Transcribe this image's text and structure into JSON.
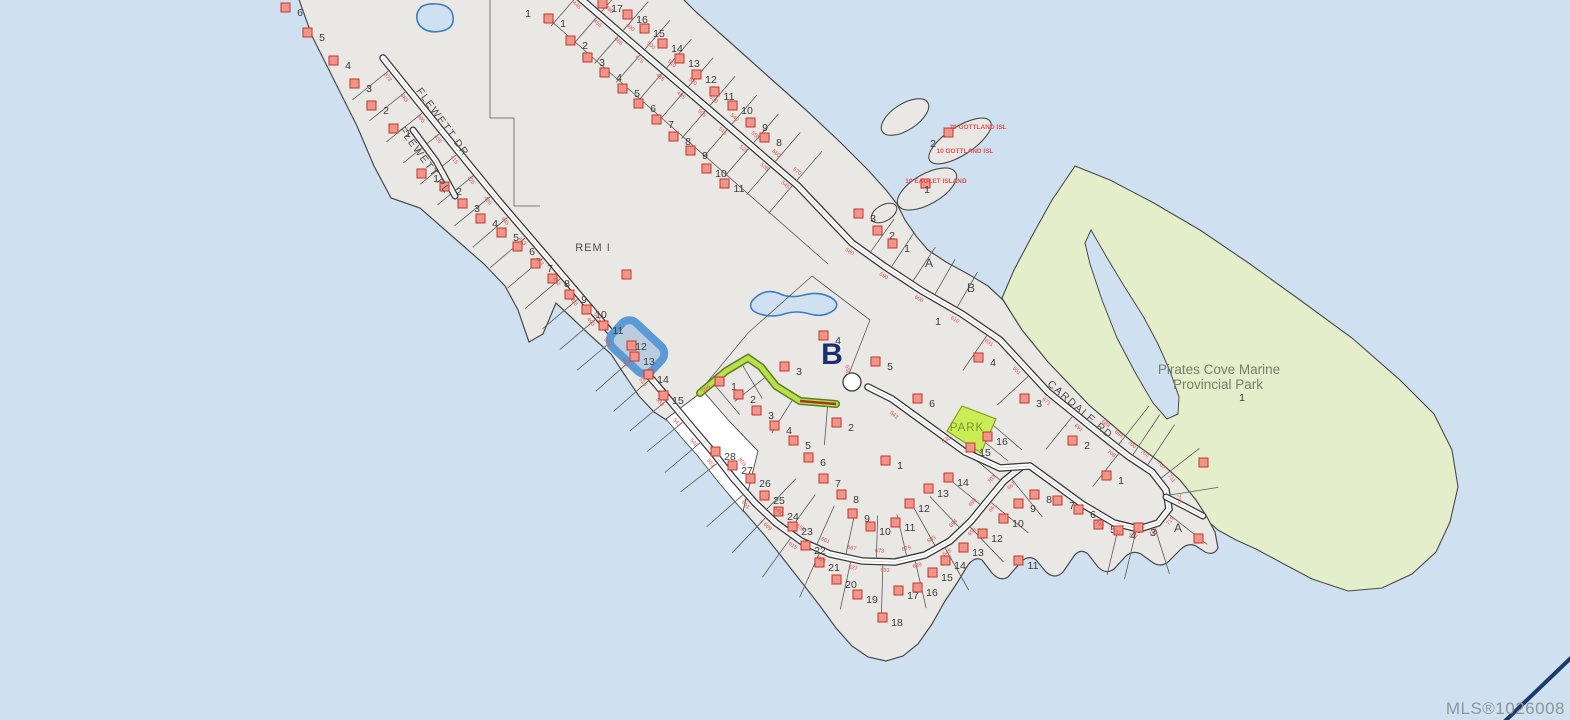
{
  "map": {
    "watermark": "MLS®1026008",
    "selected_lot": "12",
    "roads": [
      {
        "name": "FLEWETT DR"
      },
      {
        "name": "FLEWETT PL"
      },
      {
        "name": "CARDALE RD"
      }
    ],
    "areas": {
      "rem": "REM I",
      "park_name_line1": "Pirates Cove Marine",
      "park_name_line2": "Provincial Park",
      "park_lot": "1",
      "park_parcel": "PARK"
    },
    "island_labels": [
      {
        "label": "20 GOTTLAND ISL"
      },
      {
        "label": "10 GOTTLAND ISL"
      },
      {
        "label": "10 EAGLET ISLAND"
      }
    ],
    "island_lots": [
      {
        "n": "2",
        "x": 933,
        "y": 144
      },
      {
        "n": "1",
        "x": 927,
        "y": 190
      }
    ],
    "letters": [
      {
        "t": "B",
        "x": 832,
        "y": 364,
        "big": true
      },
      {
        "t": "A",
        "x": 929,
        "y": 267
      },
      {
        "t": "B",
        "x": 971,
        "y": 292
      },
      {
        "t": "A",
        "x": 1178,
        "y": 532
      }
    ],
    "lots": [
      [
        "6",
        300,
        13
      ],
      [
        "5",
        322,
        38
      ],
      [
        "4",
        348,
        66
      ],
      [
        "3",
        369,
        89
      ],
      [
        "2",
        386,
        111
      ],
      [
        "1",
        408,
        134
      ],
      [
        "1",
        436,
        179
      ],
      [
        "2",
        459,
        192
      ],
      [
        "3",
        477,
        209
      ],
      [
        "4",
        495,
        224
      ],
      [
        "5",
        516,
        238
      ],
      [
        "6",
        532,
        252
      ],
      [
        "7",
        550,
        269
      ],
      [
        "8",
        567,
        284
      ],
      [
        "9",
        584,
        300
      ],
      [
        "10",
        601,
        315
      ],
      [
        "11",
        618,
        331
      ],
      [
        "13",
        649,
        362
      ],
      [
        "14",
        663,
        380
      ],
      [
        "15",
        678,
        401
      ],
      [
        "1",
        563,
        24
      ],
      [
        "2",
        585,
        46
      ],
      [
        "3",
        602,
        63
      ],
      [
        "4",
        619,
        78
      ],
      [
        "5",
        637,
        94
      ],
      [
        "6",
        653,
        109
      ],
      [
        "7",
        671,
        125
      ],
      [
        "17",
        617,
        9
      ],
      [
        "16",
        642,
        20
      ],
      [
        "15",
        659,
        34
      ],
      [
        "14",
        677,
        49
      ],
      [
        "13",
        694,
        64
      ],
      [
        "12",
        711,
        80
      ],
      [
        "11",
        729,
        97
      ],
      [
        "10",
        747,
        111
      ],
      [
        "9",
        765,
        128
      ],
      [
        "8",
        779,
        143
      ],
      [
        "8",
        688,
        142
      ],
      [
        "9",
        705,
        156
      ],
      [
        "10",
        721,
        174
      ],
      [
        "11",
        739,
        189
      ],
      [
        "1",
        528,
        14,
        0
      ],
      [
        "1",
        938,
        322,
        0
      ],
      [
        "3",
        873,
        219
      ],
      [
        "2",
        892,
        236
      ],
      [
        "1",
        907,
        249
      ],
      [
        "4",
        838,
        341
      ],
      [
        "3",
        799,
        372
      ],
      [
        "5",
        890,
        367
      ],
      [
        "6",
        932,
        404
      ],
      [
        "2",
        851,
        428
      ],
      [
        "1",
        734,
        387
      ],
      [
        "2",
        753,
        400
      ],
      [
        "3",
        771,
        416
      ],
      [
        "4",
        789,
        431
      ],
      [
        "5",
        808,
        446
      ],
      [
        "6",
        823,
        463
      ],
      [
        "7",
        838,
        484
      ],
      [
        "8",
        856,
        500
      ],
      [
        "9",
        867,
        519
      ],
      [
        "10",
        885,
        532
      ],
      [
        "11",
        910,
        528
      ],
      [
        "12",
        924,
        509
      ],
      [
        "13",
        943,
        494
      ],
      [
        "14",
        963,
        483
      ],
      [
        "1",
        900,
        466
      ],
      [
        "28",
        730,
        457
      ],
      [
        "27",
        747,
        471
      ],
      [
        "26",
        765,
        484
      ],
      [
        "25",
        779,
        501
      ],
      [
        "24",
        793,
        517
      ],
      [
        "23",
        807,
        532
      ],
      [
        "22",
        820,
        551
      ],
      [
        "21",
        834,
        568
      ],
      [
        "20",
        851,
        585
      ],
      [
        "19",
        872,
        600
      ],
      [
        "18",
        897,
        623
      ],
      [
        "17",
        913,
        596
      ],
      [
        "16",
        932,
        593
      ],
      [
        "15",
        947,
        578
      ],
      [
        "14",
        960,
        566
      ],
      [
        "13",
        978,
        553
      ],
      [
        "12",
        997,
        539
      ],
      [
        "11",
        1033,
        566
      ],
      [
        "10",
        1018,
        524
      ],
      [
        "9",
        1033,
        509
      ],
      [
        "8",
        1049,
        500
      ],
      [
        "7",
        1072,
        506
      ],
      [
        "6",
        1093,
        515
      ],
      [
        "5",
        1113,
        530
      ],
      [
        "4",
        1133,
        536
      ],
      [
        "3",
        1153,
        533
      ],
      [
        "4",
        993,
        363
      ],
      [
        "3",
        1039,
        404
      ],
      [
        "2",
        1087,
        446
      ],
      [
        "1",
        1121,
        481
      ],
      [
        "16",
        1002,
        442
      ],
      [
        "15",
        985,
        453
      ]
    ],
    "extra_markers": [
      [
        948,
        132
      ],
      [
        925,
        183
      ],
      [
        1203,
        462
      ],
      [
        1198,
        538
      ],
      [
        626,
        274
      ]
    ],
    "dims": {
      "flewett": [
        "373",
        "383",
        "395",
        "405",
        "415",
        "425",
        "435",
        "445",
        "453",
        "463",
        "473",
        "483",
        "493",
        "503",
        "513",
        "523",
        "533",
        "543",
        "549",
        "553"
      ],
      "fan_outer": [
        "603",
        "609",
        "615",
        "621",
        "627",
        "633",
        "639",
        "645",
        "655",
        "661",
        "667"
      ],
      "fan_inner": [
        "649",
        "655",
        "661",
        "667",
        "673",
        "679",
        "683",
        "694",
        "698",
        "703"
      ],
      "strip_left": [
        "445",
        "455",
        "465",
        "475",
        "485",
        "495",
        "505",
        "515",
        "525",
        "535",
        "545"
      ],
      "strip_right": [
        "490",
        "480",
        "490",
        "500",
        "510",
        "520",
        "530",
        "540",
        "550",
        "560",
        "570"
      ],
      "cardale": [
        "580",
        "590",
        "600",
        "610",
        "631",
        "651",
        "671",
        "691",
        "708"
      ],
      "cluster": [
        "688",
        "694",
        "700",
        "703",
        "707",
        "711",
        "715",
        "719",
        "723",
        "727",
        "731",
        "749"
      ],
      "singles": [
        {
          "t": "596",
          "x": 707,
          "y": 390,
          "r": -35
        },
        {
          "t": "630",
          "x": 947,
          "y": 441,
          "r": -25
        },
        {
          "t": "643",
          "x": 893,
          "y": 416,
          "r": 42
        },
        {
          "t": "656",
          "x": 846,
          "y": 370,
          "r": 80
        },
        {
          "t": "545",
          "x": 596,
          "y": 318,
          "r": 52
        },
        {
          "t": "803",
          "x": 741,
          "y": 463,
          "r": 50
        }
      ]
    },
    "colors": {
      "water": "#cfe1f0",
      "land": "#e9e8e4",
      "park": "#e4eecb",
      "park_parcel": "#c9ee55",
      "highlight": "#5b9bd5",
      "marker_fill": "#f2948a",
      "marker_stroke": "#c0392b",
      "dim_text": "#d95050",
      "corner_line": "#1d3a6d"
    }
  }
}
